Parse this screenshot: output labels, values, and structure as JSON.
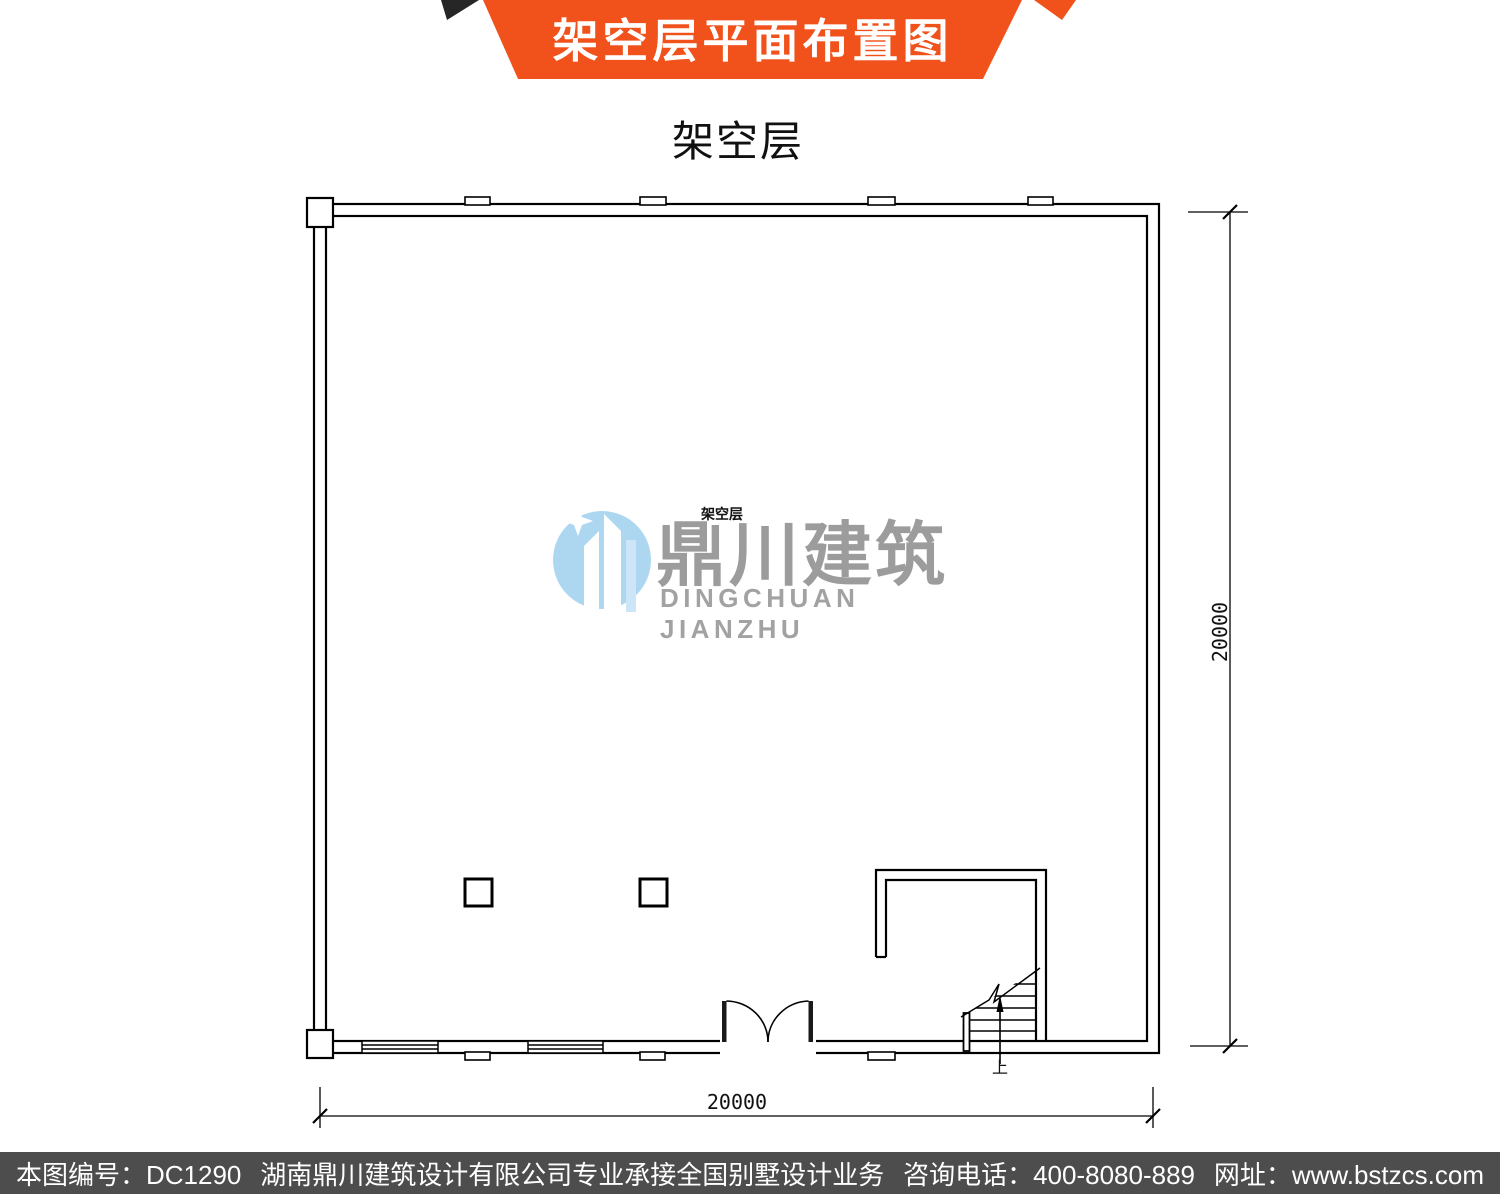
{
  "banner": {
    "title": "架空层平面布置图",
    "color": "#F1521B",
    "fold_color": "#262626"
  },
  "subtitle": "架空层",
  "plan": {
    "room_label": "架空层",
    "stair_up_label": "上",
    "dim_right": "20000",
    "dim_bottom": "20000",
    "line_color": "#000000"
  },
  "watermark": {
    "logo_cn": "鼎川建筑",
    "logo_en": "DINGCHUAN JIANZHU",
    "text_color": "#9C9C9C",
    "logo_blue": "#ADD6F0"
  },
  "footer": {
    "bg_color": "#4D4D4D",
    "segments": [
      "本图编号：DC1290",
      "湖南鼎川建筑设计有限公司专业承接全国别墅设计业务",
      "咨询电话：400-8080-889",
      "网址：www.bstzcs.com"
    ]
  }
}
